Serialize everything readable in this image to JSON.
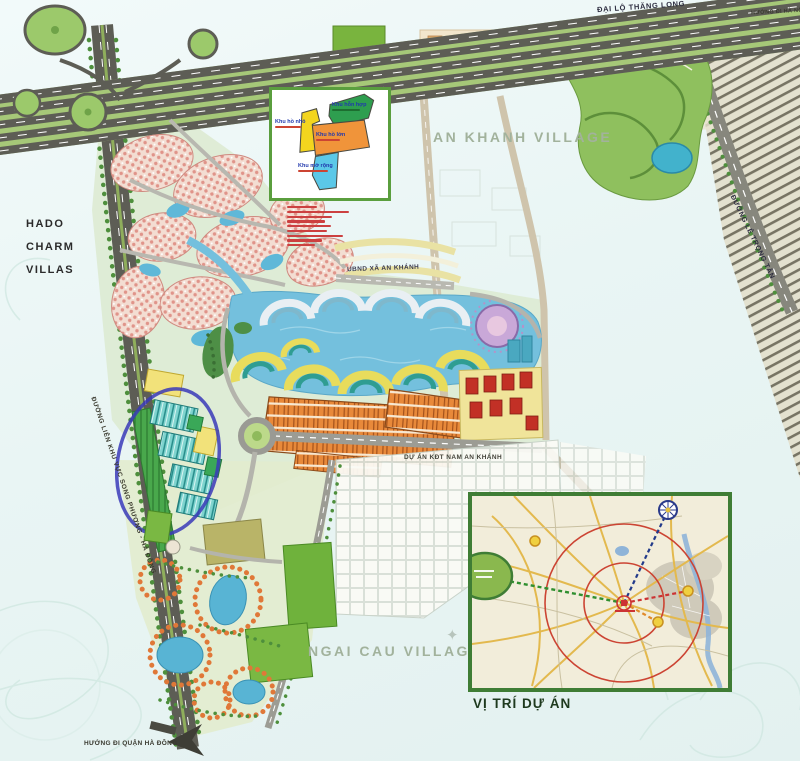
{
  "map": {
    "region_labels": {
      "an_khanh_village": "AN KHANH VILLAGE",
      "ngai_cau_village": "NGAI CAU VILLAGE",
      "hado_line1": "HADO",
      "hado_line2": "CHARM",
      "hado_line3": "VILLAS"
    },
    "road_labels": {
      "thang_long": "ĐẠI LỘ THĂNG LONG",
      "huong_di_ha_noi": "HƯỚNG ĐI HÀ NỘI",
      "le_trong_tan": "ĐƯỜNG LÊ TRỌNG TẤN",
      "lien_khu_vuc": "ĐƯỜNG LIÊN KHU VỰC SONG PHƯƠNG - HÀ ĐÔNG",
      "huong_di_ha_dong": "HƯỚNG ĐI QUẬN HÀ ĐÔNG"
    },
    "site_labels": {
      "ubnd": "UBND XÃ AN KHÁNH",
      "nam_an_khanh": "DỰ ÁN KĐT NAM AN KHÁNH"
    }
  },
  "legend": {
    "zones": [
      {
        "label": "Khu hồ nhỏ",
        "color": "#f3d51e"
      },
      {
        "label": "Khu hỗn hợp",
        "color": "#2e9e4f"
      },
      {
        "label": "Khu hồ lớn",
        "color": "#f0943a"
      },
      {
        "label": "Khu mở rộng",
        "color": "#5bc8e8"
      }
    ],
    "note_line_widths": [
      30,
      62,
      45,
      38,
      44,
      40,
      56,
      35,
      28
    ]
  },
  "inset": {
    "caption": "VỊ TRÍ DỰ ÁN",
    "ring_color": "#cc4433",
    "border_color": "#3f7d35"
  },
  "colors": {
    "lake": "#74c0dd",
    "highway_green": "#a6c878",
    "orange_zone": "#e8893a",
    "annotation_ellipse": "#3a3ab8"
  }
}
